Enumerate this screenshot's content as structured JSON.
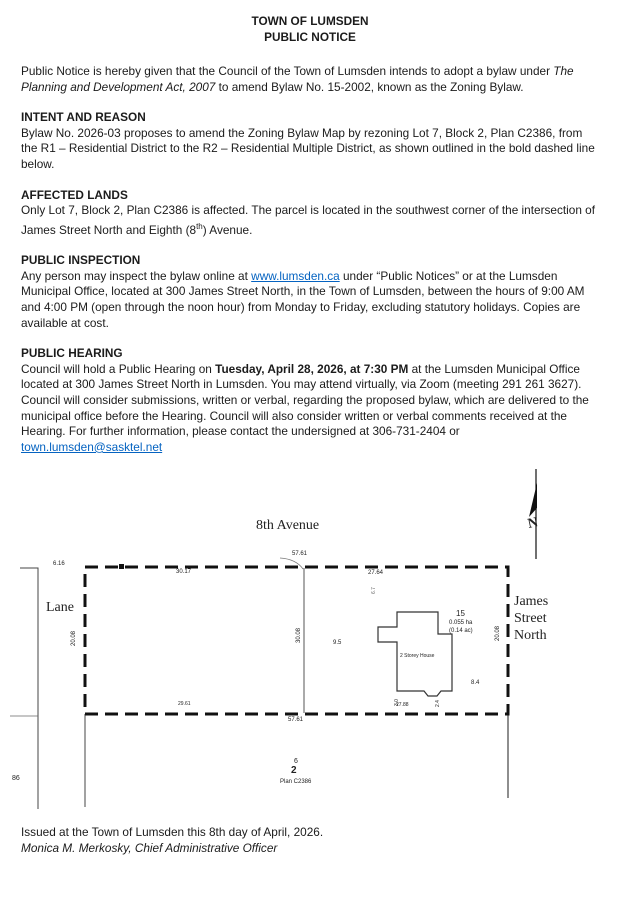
{
  "document": {
    "title_line1": "TOWN OF LUMSDEN",
    "title_line2": "PUBLIC NOTICE",
    "intro": {
      "pre": "Public Notice is hereby given that the Council of the Town of Lumsden intends to adopt a bylaw under ",
      "act": "The Planning and Development Act, 2007",
      "post": " to amend Bylaw No. 15-2002, known as the Zoning Bylaw."
    },
    "intent": {
      "heading": "INTENT AND REASON",
      "body": "Bylaw No. 2026-03 proposes to amend the Zoning Bylaw Map by rezoning Lot 7, Block 2, Plan C2386, from the R1 – Residential District to the R2 – Residential Multiple District, as shown outlined in the bold dashed line below."
    },
    "affected": {
      "heading": "AFFECTED LANDS",
      "body_pre": "Only Lot 7, Block 2, Plan C2386 is affected.  The parcel is located in the southwest corner of the intersection of James Street North and Eighth (8",
      "sup": "th",
      "body_post": ") Avenue."
    },
    "inspection": {
      "heading": "PUBLIC INSPECTION",
      "pre": "Any person may inspect the bylaw online at ",
      "link": "www.lumsden.ca",
      "post": " under “Public Notices” or at the Lumsden Municipal Office, located at 300 James Street North, in the Town of Lumsden, between the hours of 9:00 AM and 4:00 PM (open through the noon hour) from Monday to Friday, excluding statutory holidays. Copies are available at cost."
    },
    "hearing": {
      "heading": "PUBLIC HEARING",
      "pre": "Council will hold a Public Hearing on ",
      "bold": "Tuesday, April 28, 2026, at 7:30 PM",
      "mid": " at the Lumsden Municipal Office located at 300 James Street North in Lumsden. You may attend virtually, via Zoom (meeting 291 261 3627). Council will consider submissions, written or verbal, regarding the proposed bylaw, which are delivered to the municipal office before the Hearing. Council will also consider written or verbal comments received at the Hearing. For further information, please contact the undersigned at 306-731-2404 or ",
      "link": "town.lumsden@sasktel.net"
    },
    "footer": {
      "line1": "Issued at the Town of Lumsden this 8th day of April, 2026.",
      "line2": "Monica M. Merkosky, Chief Administrative Officer"
    }
  },
  "map": {
    "street_top": "8th Avenue",
    "lane": "Lane",
    "street_right_1": "James",
    "street_right_2": "Street",
    "street_right_3": "North",
    "north_label": "N",
    "dim_top_total": "57.61",
    "dim_top_left": "30.17",
    "dim_top_right": "27.64",
    "dim_lane_offset": "6.16",
    "dim_left_side": "20.08",
    "dim_mid_side": "30.08",
    "dim_right_side": "20.08",
    "dim_house_left": "9.5",
    "dim_small_right": "6.7",
    "lot_number": "15",
    "area_ha": "0.055 ha",
    "area_ac": "(0.14 ac)",
    "house_label": "2 Storey House",
    "dim_8_4": "8.4",
    "dim_3_0": "3.0",
    "dim_2_4": "2.4",
    "dim_27_88": "27.88",
    "dim_bottom_left": "29.61",
    "dim_bottom_total": "57.61",
    "lot_below_small": "6",
    "block_number": "2",
    "plan_label": "Plan C2386",
    "edge_mark": "86",
    "line_color": "#1a1a1a"
  }
}
